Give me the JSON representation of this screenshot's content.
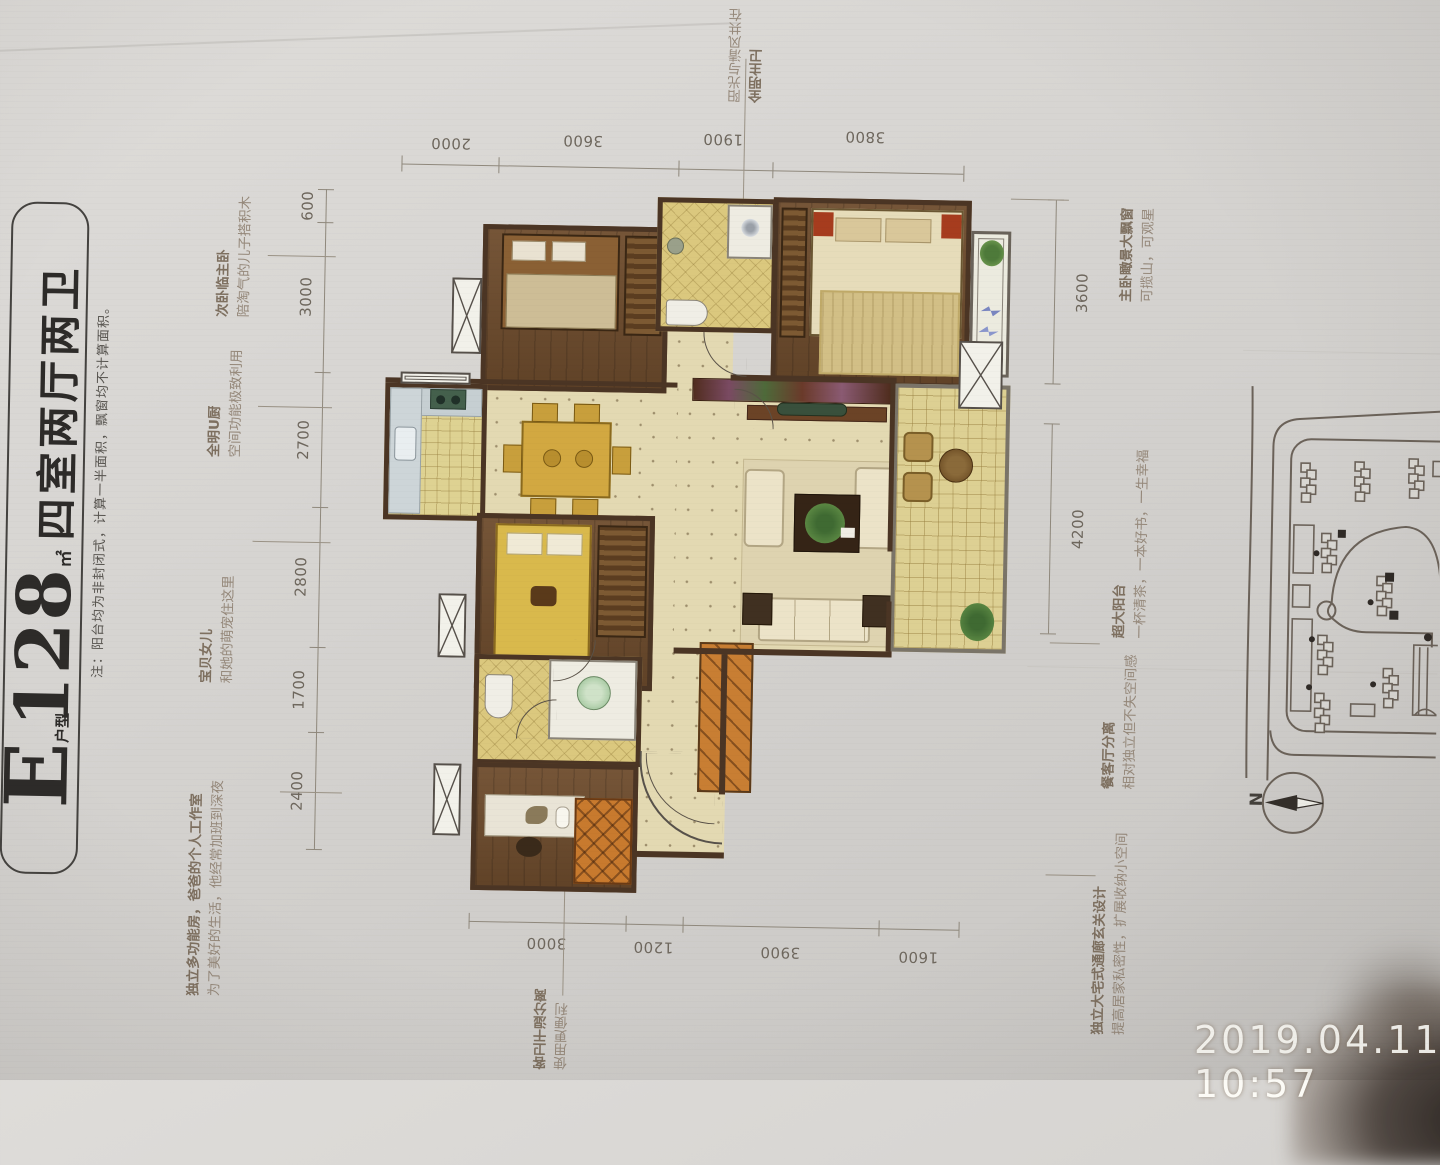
{
  "photo": {
    "timestamp": "2019.04.11 10:57"
  },
  "title_block": {
    "letter": "E",
    "letter_suffix": "户型",
    "area": "128",
    "area_unit": "㎡",
    "layout": "四室两厅两卫",
    "note": "注：阳台均为非封闭式，计算一半面积，飘窗均不计算面积。"
  },
  "compass": {
    "label": "N"
  },
  "dimensions": {
    "top": [
      "2000",
      "3600",
      "1900",
      "3800"
    ],
    "left": [
      "600",
      "3000",
      "2700",
      "2800",
      "1700",
      "2400"
    ],
    "right": [
      "3600",
      "4200"
    ],
    "bottom": [
      "3000",
      "1200",
      "3900",
      "1600"
    ]
  },
  "annotations": {
    "left": [
      {
        "title": "次卧临主卧",
        "subtitle": "陪淘气的儿子搭积木"
      },
      {
        "title": "全明U厨",
        "subtitle": "空间功能极致利用"
      },
      {
        "title": "宝贝女儿",
        "subtitle": "和她的萌宠住这里"
      },
      {
        "title": "独立多功能房，爸爸的个人工作室",
        "subtitle": "为了美好的生活，他经常加班到深夜"
      }
    ],
    "right": [
      {
        "title": "主卧瞰景大飘窗",
        "subtitle": "可揽山，可观星"
      },
      {
        "title": "超大阳台",
        "subtitle": "一杯清茶，一本好书，一生幸福"
      },
      {
        "title": "餐客厅分离",
        "subtitle": "相对独立但不失空间感"
      },
      {
        "title": "独立大宅式通廊玄关设计",
        "subtitle": "提高居家私密性，扩展收纳小空间"
      }
    ],
    "top": {
      "title": "全明主卫",
      "subtitle": "阳光与清风共在"
    },
    "bottom": {
      "title": "客卫干湿分离",
      "subtitle": "使用更便利"
    }
  },
  "colors": {
    "wall": "#4b3524",
    "wood_floor": "#6e4c2d",
    "tile_floor": "#dbc87e",
    "hall_floor": "#e3d9b2",
    "paper": "#d6d4d1"
  }
}
